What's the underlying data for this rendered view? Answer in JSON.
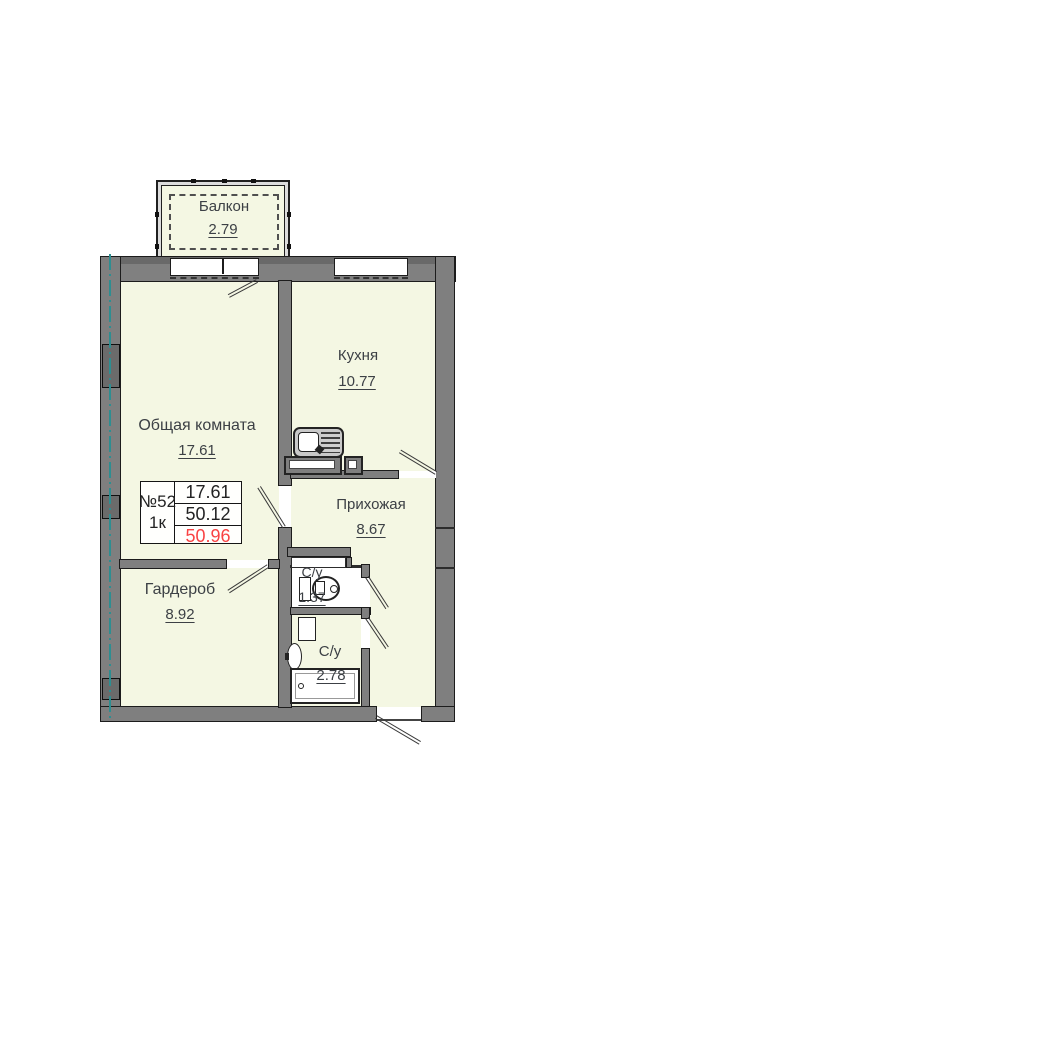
{
  "colors": {
    "room_fill": "#f4f7e3",
    "wall_gray": "#7f7f7f",
    "outline": "#1c1c1c",
    "axis_teal": "#2d8e91",
    "text": "#3c4045",
    "total_area_red": "#f94343"
  },
  "unit": {
    "number": "№52",
    "type": "1к"
  },
  "area_table": {
    "values": [
      "17.61",
      "50.12",
      "50.96"
    ]
  },
  "rooms": [
    {
      "name": "balcony",
      "label": "Балкон",
      "area": "2.79"
    },
    {
      "name": "kitchen",
      "label": "Кухня",
      "area": "10.77"
    },
    {
      "name": "living-room",
      "label": "Общая комната",
      "area": "17.61"
    },
    {
      "name": "hallway",
      "label": "Прихожая",
      "area": "8.67"
    },
    {
      "name": "wardrobe",
      "label": "Гардероб",
      "area": "8.92"
    },
    {
      "name": "bathroom-small",
      "label": "С/у",
      "area": "1.37"
    },
    {
      "name": "bathroom",
      "label": "С/у",
      "area": "2.78"
    }
  ]
}
